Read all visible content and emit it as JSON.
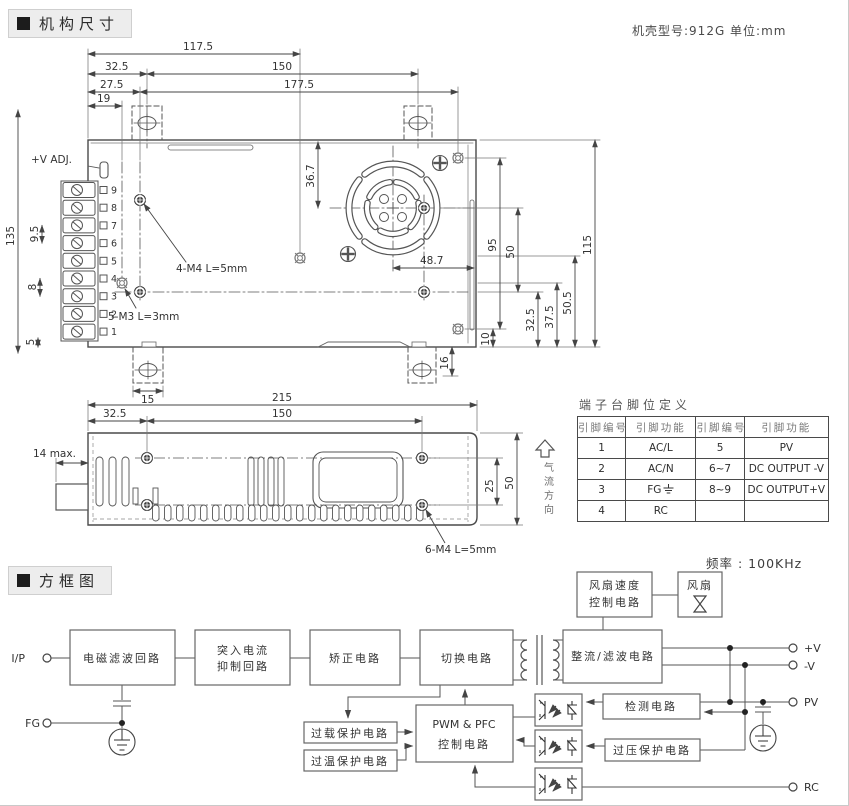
{
  "header": {
    "section_mech": "机构尺寸",
    "section_block": "方框图",
    "case_note": "机壳型号:912G  单位:mm",
    "freq_note": "频率 : 100KHz"
  },
  "mech": {
    "dim_117_5": "117.5",
    "dim_32_5": "32.5",
    "dim_150": "150",
    "dim_27_5": "27.5",
    "dim_177_5": "177.5",
    "dim_19": "19",
    "dim_135": "135",
    "dim_9_5": "9.5",
    "dim_8": "8",
    "dim_5": "5",
    "dim_36_7": "36.7",
    "dim_48_7": "48.7",
    "dim_95": "95",
    "dim_50": "50",
    "dim_115": "115",
    "dim_50_5": "50.5",
    "dim_37_5": "37.5",
    "dim_32_5b": "32.5",
    "dim_10": "10",
    "dim_16": "16",
    "dim_15": "15",
    "label_vadj": "+V ADJ.",
    "label_m4": "4-M4 L=5mm",
    "label_m3": "5-M3 L=3mm",
    "pins": [
      "9",
      "8",
      "7",
      "6",
      "5",
      "4",
      "3",
      "2",
      "1"
    ]
  },
  "side": {
    "dim_215": "215",
    "dim_32_5": "32.5",
    "dim_150": "150",
    "dim_14": "14 max.",
    "dim_25": "25",
    "dim_50": "50",
    "label_m4": "6-M4 L=5mm"
  },
  "airflow": {
    "c0": "气",
    "c1": "流",
    "c2": "方",
    "c3": "向"
  },
  "pin_table": {
    "title": "端子台脚位定义",
    "headers": [
      "引脚编号",
      "引脚功能",
      "引脚编号",
      "引脚功能"
    ],
    "rows": [
      [
        "1",
        "AC/L",
        "5",
        "PV"
      ],
      [
        "2",
        "AC/N",
        "6~7",
        "DC OUTPUT -V"
      ],
      [
        "3",
        "FG",
        "8~9",
        "DC OUTPUT+V"
      ],
      [
        "4",
        "RC",
        "",
        ""
      ]
    ]
  },
  "block": {
    "t_ip": "I/P",
    "t_fg": "FG",
    "t_vp": "+V",
    "t_vm": "-V",
    "t_pv": "PV",
    "t_rc": "RC",
    "emi": "电磁滤波回路",
    "inrush1": "突入电流",
    "inrush2": "抑制回路",
    "rectify": "矫正电路",
    "switch": "切换电路",
    "outfilter": "整流/滤波电路",
    "fanspeed1": "风扇速度",
    "fanspeed2": "控制电路",
    "fan": "风扇",
    "pwm1": "PWM & PFC",
    "pwm2": "控制电路",
    "overload": "过载保护电路",
    "overtemp": "过温保护电路",
    "detect": "检测电路",
    "overvolt": "过压保护电路"
  }
}
